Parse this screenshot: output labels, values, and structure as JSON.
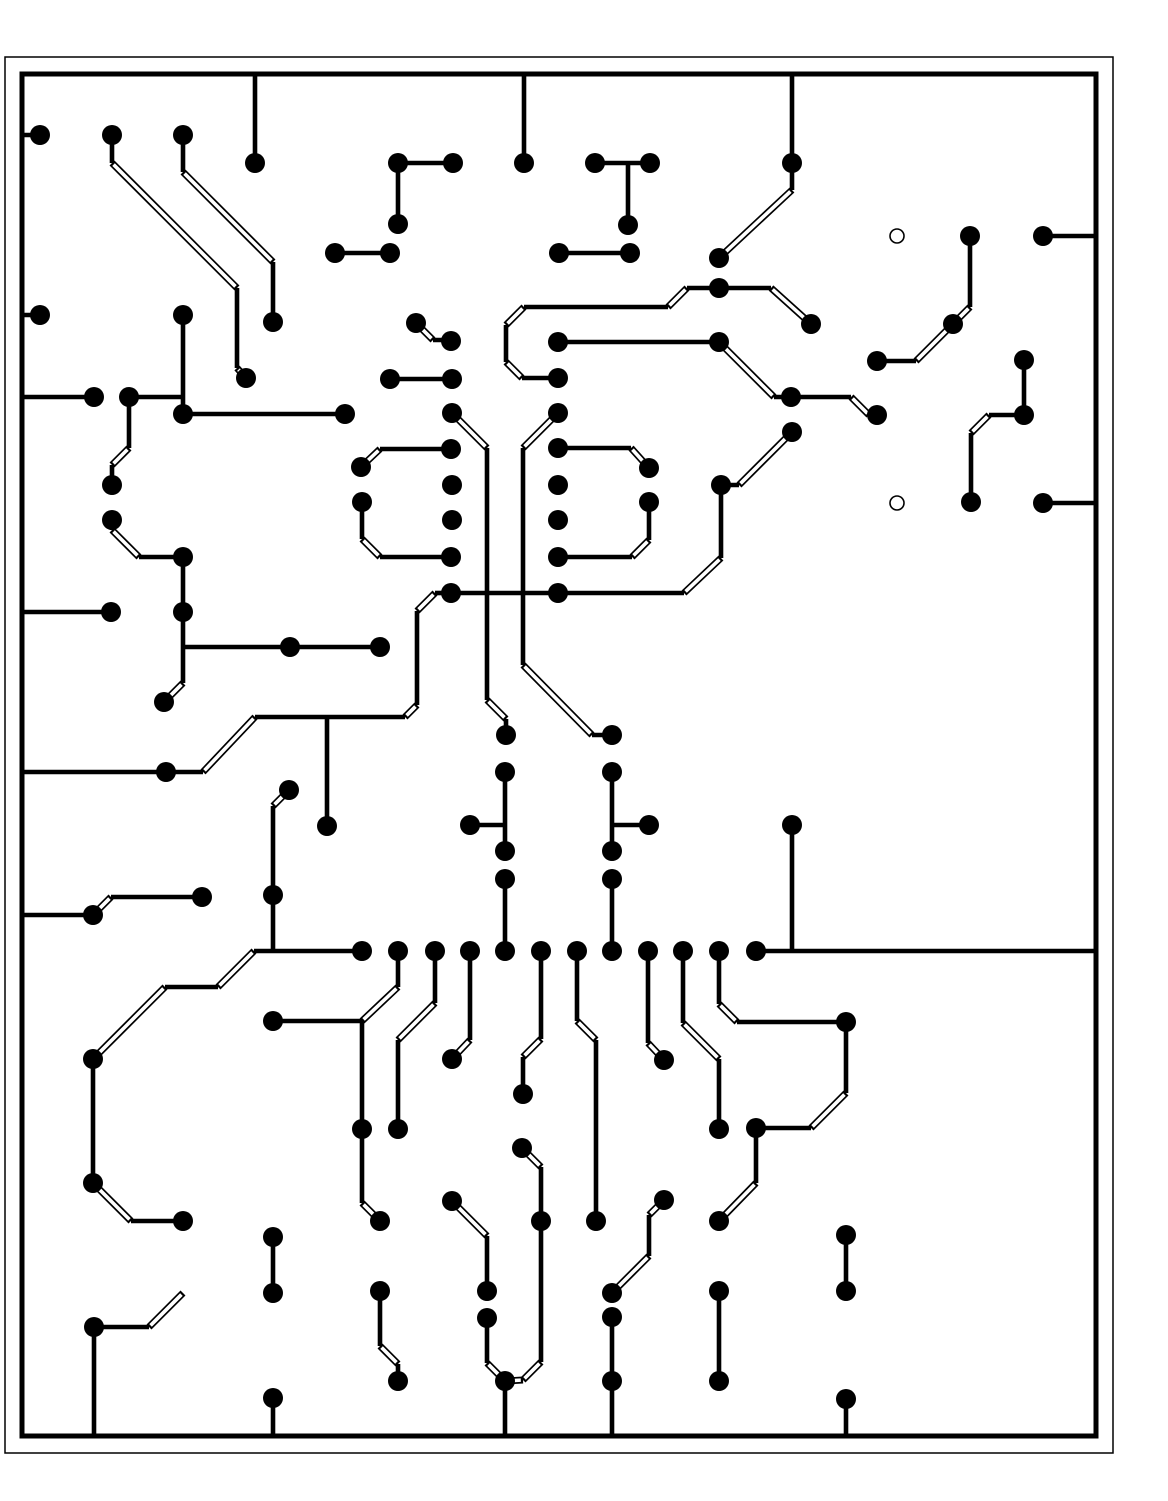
{
  "canvas": {
    "width": 1168,
    "height": 1501,
    "background": "#ffffff",
    "ink": "#000000"
  },
  "board": {
    "outer_rect": {
      "x": 5,
      "y": 57,
      "w": 1108,
      "h": 1396,
      "stroke_w": 1.5
    },
    "inner_rect": {
      "x": 22,
      "y": 74,
      "w": 1074,
      "h": 1362,
      "stroke_w": 5
    }
  },
  "style": {
    "pad_radius": 10,
    "hole_radius": 7,
    "hole_stroke": 1.6,
    "trace_width": 4.6,
    "diag_outer_width": 7,
    "diag_inner_width": 3.6
  },
  "holes": [
    [
      897,
      236
    ],
    [
      897,
      503
    ]
  ],
  "pads": [
    [
      40,
      135
    ],
    [
      112,
      135
    ],
    [
      183,
      135
    ],
    [
      255,
      163
    ],
    [
      398,
      163
    ],
    [
      453,
      163
    ],
    [
      524,
      163
    ],
    [
      595,
      163
    ],
    [
      650,
      163
    ],
    [
      628,
      225
    ],
    [
      398,
      224
    ],
    [
      335,
      253
    ],
    [
      390,
      253
    ],
    [
      559,
      253
    ],
    [
      630,
      253
    ],
    [
      792,
      163
    ],
    [
      719,
      258
    ],
    [
      719,
      288
    ],
    [
      811,
      324
    ],
    [
      970,
      236
    ],
    [
      1043,
      236
    ],
    [
      40,
      315
    ],
    [
      183,
      315
    ],
    [
      273,
      322
    ],
    [
      246,
      378
    ],
    [
      94,
      397
    ],
    [
      129,
      397
    ],
    [
      112,
      485
    ],
    [
      112,
      520
    ],
    [
      183,
      414
    ],
    [
      345,
      414
    ],
    [
      416,
      323
    ],
    [
      451,
      341
    ],
    [
      390,
      379
    ],
    [
      452,
      379
    ],
    [
      452,
      413
    ],
    [
      451,
      449
    ],
    [
      452,
      485
    ],
    [
      452,
      520
    ],
    [
      451,
      557
    ],
    [
      451,
      593
    ],
    [
      558,
      342
    ],
    [
      558,
      378
    ],
    [
      558,
      413
    ],
    [
      558,
      448
    ],
    [
      558,
      485
    ],
    [
      558,
      520
    ],
    [
      558,
      557
    ],
    [
      558,
      593
    ],
    [
      361,
      467
    ],
    [
      362,
      502
    ],
    [
      183,
      557
    ],
    [
      719,
      342
    ],
    [
      791,
      397
    ],
    [
      877,
      415
    ],
    [
      877,
      361
    ],
    [
      953,
      324
    ],
    [
      649,
      468
    ],
    [
      649,
      502
    ],
    [
      721,
      485
    ],
    [
      792,
      432
    ],
    [
      1024,
      360
    ],
    [
      1024,
      415
    ],
    [
      971,
      502
    ],
    [
      1043,
      503
    ],
    [
      164,
      702
    ],
    [
      111,
      612
    ],
    [
      183,
      612
    ],
    [
      290,
      647
    ],
    [
      380,
      647
    ],
    [
      166,
      772
    ],
    [
      327,
      826
    ],
    [
      289,
      790
    ],
    [
      273,
      895
    ],
    [
      506,
      735
    ],
    [
      612,
      735
    ],
    [
      505,
      772
    ],
    [
      470,
      825
    ],
    [
      505,
      851
    ],
    [
      505,
      879
    ],
    [
      612,
      772
    ],
    [
      649,
      825
    ],
    [
      612,
      851
    ],
    [
      612,
      879
    ],
    [
      792,
      825
    ],
    [
      93,
      915
    ],
    [
      202,
      897
    ],
    [
      273,
      1021
    ],
    [
      93,
      1059
    ],
    [
      93,
      1183
    ],
    [
      183,
      1221
    ],
    [
      362,
      951
    ],
    [
      398,
      951
    ],
    [
      435,
      951
    ],
    [
      470,
      951
    ],
    [
      505,
      951
    ],
    [
      541,
      951
    ],
    [
      577,
      951
    ],
    [
      612,
      951
    ],
    [
      648,
      951
    ],
    [
      683,
      951
    ],
    [
      719,
      951
    ],
    [
      756,
      951
    ],
    [
      452,
      1059
    ],
    [
      523,
      1094
    ],
    [
      522,
      1148
    ],
    [
      362,
      1129
    ],
    [
      398,
      1129
    ],
    [
      664,
      1060
    ],
    [
      846,
      1022
    ],
    [
      719,
      1129
    ],
    [
      756,
      1128
    ],
    [
      380,
      1221
    ],
    [
      380,
      1291
    ],
    [
      398,
      1381
    ],
    [
      452,
      1201
    ],
    [
      487,
      1291
    ],
    [
      487,
      1318
    ],
    [
      505,
      1381
    ],
    [
      541,
      1221
    ],
    [
      596,
      1221
    ],
    [
      664,
      1200
    ],
    [
      612,
      1293
    ],
    [
      612,
      1317
    ],
    [
      612,
      1381
    ],
    [
      719,
      1221
    ],
    [
      719,
      1291
    ],
    [
      719,
      1381
    ],
    [
      846,
      1235
    ],
    [
      846,
      1291
    ],
    [
      846,
      1399
    ],
    [
      273,
      1237
    ],
    [
      273,
      1293
    ],
    [
      94,
      1327
    ],
    [
      273,
      1398
    ]
  ],
  "traces": [
    [
      [
        22,
        135
      ],
      [
        40,
        135
      ]
    ],
    [
      [
        112,
        135
      ],
      [
        112,
        163
      ],
      [
        237,
        288
      ],
      [
        237,
        368
      ],
      [
        246,
        378
      ]
    ],
    [
      [
        183,
        135
      ],
      [
        183,
        172
      ],
      [
        273,
        262
      ],
      [
        273,
        322
      ]
    ],
    [
      [
        255,
        74
      ],
      [
        255,
        163
      ]
    ],
    [
      [
        398,
        163
      ],
      [
        453,
        163
      ]
    ],
    [
      [
        398,
        163
      ],
      [
        398,
        224
      ]
    ],
    [
      [
        524,
        74
      ],
      [
        524,
        163
      ]
    ],
    [
      [
        335,
        253
      ],
      [
        390,
        253
      ]
    ],
    [
      [
        559,
        253
      ],
      [
        630,
        253
      ]
    ],
    [
      [
        595,
        163
      ],
      [
        650,
        163
      ]
    ],
    [
      [
        628,
        163
      ],
      [
        628,
        225
      ]
    ],
    [
      [
        792,
        74
      ],
      [
        792,
        163
      ]
    ],
    [
      [
        792,
        163
      ],
      [
        792,
        190
      ],
      [
        719,
        258
      ]
    ],
    [
      [
        558,
        378
      ],
      [
        522,
        378
      ],
      [
        506,
        362
      ],
      [
        506,
        325
      ],
      [
        524,
        307
      ],
      [
        668,
        307
      ],
      [
        687,
        288
      ],
      [
        771,
        288
      ],
      [
        811,
        324
      ]
    ],
    [
      [
        416,
        323
      ],
      [
        433,
        340
      ],
      [
        451,
        340
      ]
    ],
    [
      [
        390,
        379
      ],
      [
        452,
        379
      ]
    ],
    [
      [
        22,
        315
      ],
      [
        40,
        315
      ]
    ],
    [
      [
        22,
        397
      ],
      [
        94,
        397
      ]
    ],
    [
      [
        129,
        397
      ],
      [
        183,
        397
      ]
    ],
    [
      [
        183,
        315
      ],
      [
        183,
        414
      ]
    ],
    [
      [
        183,
        414
      ],
      [
        345,
        414
      ]
    ],
    [
      [
        129,
        397
      ],
      [
        129,
        448
      ],
      [
        112,
        465
      ],
      [
        112,
        485
      ]
    ],
    [
      [
        112,
        520
      ],
      [
        112,
        530
      ],
      [
        139,
        557
      ],
      [
        183,
        557
      ]
    ],
    [
      [
        183,
        557
      ],
      [
        183,
        683
      ],
      [
        164,
        702
      ]
    ],
    [
      [
        183,
        647
      ],
      [
        290,
        647
      ]
    ],
    [
      [
        290,
        647
      ],
      [
        380,
        647
      ]
    ],
    [
      [
        22,
        612
      ],
      [
        111,
        612
      ]
    ],
    [
      [
        22,
        772
      ],
      [
        203,
        772
      ],
      [
        255,
        717
      ],
      [
        405,
        717
      ],
      [
        417,
        705
      ],
      [
        417,
        611
      ],
      [
        435,
        593
      ],
      [
        451,
        593
      ]
    ],
    [
      [
        327,
        717
      ],
      [
        327,
        826
      ]
    ],
    [
      [
        289,
        790
      ],
      [
        273,
        806
      ],
      [
        273,
        895
      ]
    ],
    [
      [
        452,
        413
      ],
      [
        487,
        448
      ],
      [
        487,
        700
      ],
      [
        506,
        719
      ],
      [
        506,
        735
      ]
    ],
    [
      [
        558,
        413
      ],
      [
        523,
        448
      ],
      [
        523,
        665
      ],
      [
        592,
        735
      ],
      [
        612,
        735
      ]
    ],
    [
      [
        558,
        342
      ],
      [
        719,
        342
      ]
    ],
    [
      [
        719,
        342
      ],
      [
        774,
        397
      ],
      [
        791,
        397
      ]
    ],
    [
      [
        791,
        397
      ],
      [
        851,
        397
      ],
      [
        869,
        415
      ],
      [
        877,
        415
      ]
    ],
    [
      [
        877,
        361
      ],
      [
        916,
        361
      ],
      [
        953,
        324
      ],
      [
        970,
        307
      ],
      [
        970,
        236
      ]
    ],
    [
      [
        1043,
        236
      ],
      [
        1096,
        236
      ]
    ],
    [
      [
        1024,
        360
      ],
      [
        1024,
        415
      ]
    ],
    [
      [
        1024,
        415
      ],
      [
        989,
        415
      ],
      [
        971,
        433
      ],
      [
        971,
        502
      ]
    ],
    [
      [
        1043,
        503
      ],
      [
        1096,
        503
      ]
    ],
    [
      [
        558,
        448
      ],
      [
        631,
        448
      ],
      [
        649,
        468
      ]
    ],
    [
      [
        649,
        502
      ],
      [
        649,
        540
      ],
      [
        632,
        557
      ],
      [
        558,
        557
      ]
    ],
    [
      [
        361,
        467
      ],
      [
        380,
        449
      ],
      [
        451,
        449
      ]
    ],
    [
      [
        362,
        502
      ],
      [
        362,
        539
      ],
      [
        380,
        557
      ],
      [
        451,
        557
      ]
    ],
    [
      [
        792,
        432
      ],
      [
        739,
        485
      ],
      [
        721,
        485
      ]
    ],
    [
      [
        721,
        485
      ],
      [
        721,
        558
      ],
      [
        684,
        593
      ],
      [
        451,
        593
      ]
    ],
    [
      [
        22,
        915
      ],
      [
        93,
        915
      ]
    ],
    [
      [
        93,
        915
      ],
      [
        111,
        897
      ],
      [
        202,
        897
      ]
    ],
    [
      [
        93,
        1059
      ],
      [
        165,
        987
      ],
      [
        218,
        987
      ],
      [
        254,
        951
      ],
      [
        362,
        951
      ]
    ],
    [
      [
        273,
        895
      ],
      [
        273,
        951
      ]
    ],
    [
      [
        93,
        1059
      ],
      [
        93,
        1183
      ]
    ],
    [
      [
        93,
        1183
      ],
      [
        131,
        1221
      ],
      [
        183,
        1221
      ]
    ],
    [
      [
        273,
        1021
      ],
      [
        362,
        1021
      ]
    ],
    [
      [
        398,
        951
      ],
      [
        398,
        987
      ],
      [
        362,
        1021
      ]
    ],
    [
      [
        362,
        1021
      ],
      [
        362,
        1129
      ]
    ],
    [
      [
        362,
        1129
      ],
      [
        362,
        1203
      ],
      [
        380,
        1221
      ]
    ],
    [
      [
        398,
        1129
      ],
      [
        398,
        1040
      ],
      [
        435,
        1003
      ],
      [
        435,
        951
      ]
    ],
    [
      [
        470,
        951
      ],
      [
        470,
        1040
      ],
      [
        452,
        1059
      ]
    ],
    [
      [
        541,
        951
      ],
      [
        541,
        1039
      ],
      [
        523,
        1057
      ],
      [
        523,
        1094
      ]
    ],
    [
      [
        577,
        951
      ],
      [
        577,
        1021
      ],
      [
        596,
        1040
      ],
      [
        596,
        1221
      ]
    ],
    [
      [
        505,
        879
      ],
      [
        505,
        951
      ]
    ],
    [
      [
        612,
        879
      ],
      [
        612,
        951
      ]
    ],
    [
      [
        505,
        772
      ],
      [
        505,
        851
      ]
    ],
    [
      [
        505,
        825
      ],
      [
        470,
        825
      ]
    ],
    [
      [
        612,
        772
      ],
      [
        612,
        851
      ]
    ],
    [
      [
        612,
        825
      ],
      [
        649,
        825
      ]
    ],
    [
      [
        648,
        951
      ],
      [
        648,
        1043
      ],
      [
        664,
        1060
      ]
    ],
    [
      [
        683,
        951
      ],
      [
        683,
        1023
      ],
      [
        719,
        1059
      ],
      [
        719,
        1129
      ]
    ],
    [
      [
        719,
        951
      ],
      [
        719,
        1004
      ],
      [
        737,
        1022
      ],
      [
        846,
        1022
      ]
    ],
    [
      [
        846,
        1022
      ],
      [
        846,
        1093
      ],
      [
        811,
        1128
      ],
      [
        756,
        1128
      ]
    ],
    [
      [
        756,
        1128
      ],
      [
        756,
        1183
      ],
      [
        719,
        1221
      ]
    ],
    [
      [
        522,
        1148
      ],
      [
        541,
        1167
      ],
      [
        541,
        1362
      ],
      [
        523,
        1380
      ],
      [
        505,
        1381
      ]
    ],
    [
      [
        505,
        1381
      ],
      [
        505,
        1436
      ]
    ],
    [
      [
        487,
        1318
      ],
      [
        487,
        1363
      ],
      [
        505,
        1381
      ]
    ],
    [
      [
        452,
        1201
      ],
      [
        487,
        1236
      ],
      [
        487,
        1291
      ]
    ],
    [
      [
        380,
        1291
      ],
      [
        380,
        1346
      ],
      [
        398,
        1364
      ],
      [
        398,
        1381
      ]
    ],
    [
      [
        273,
        1237
      ],
      [
        273,
        1293
      ]
    ],
    [
      [
        183,
        1293
      ],
      [
        149,
        1327
      ],
      [
        94,
        1327
      ]
    ],
    [
      [
        94,
        1327
      ],
      [
        94,
        1436
      ]
    ],
    [
      [
        273,
        1398
      ],
      [
        273,
        1436
      ]
    ],
    [
      [
        756,
        951
      ],
      [
        1096,
        951
      ]
    ],
    [
      [
        792,
        825
      ],
      [
        792,
        951
      ]
    ],
    [
      [
        664,
        1200
      ],
      [
        649,
        1215
      ],
      [
        649,
        1256
      ],
      [
        612,
        1293
      ]
    ],
    [
      [
        612,
        1317
      ],
      [
        612,
        1381
      ]
    ],
    [
      [
        612,
        1381
      ],
      [
        612,
        1436
      ]
    ],
    [
      [
        719,
        1291
      ],
      [
        719,
        1381
      ]
    ],
    [
      [
        846,
        1235
      ],
      [
        846,
        1291
      ]
    ],
    [
      [
        846,
        1399
      ],
      [
        846,
        1436
      ]
    ]
  ]
}
